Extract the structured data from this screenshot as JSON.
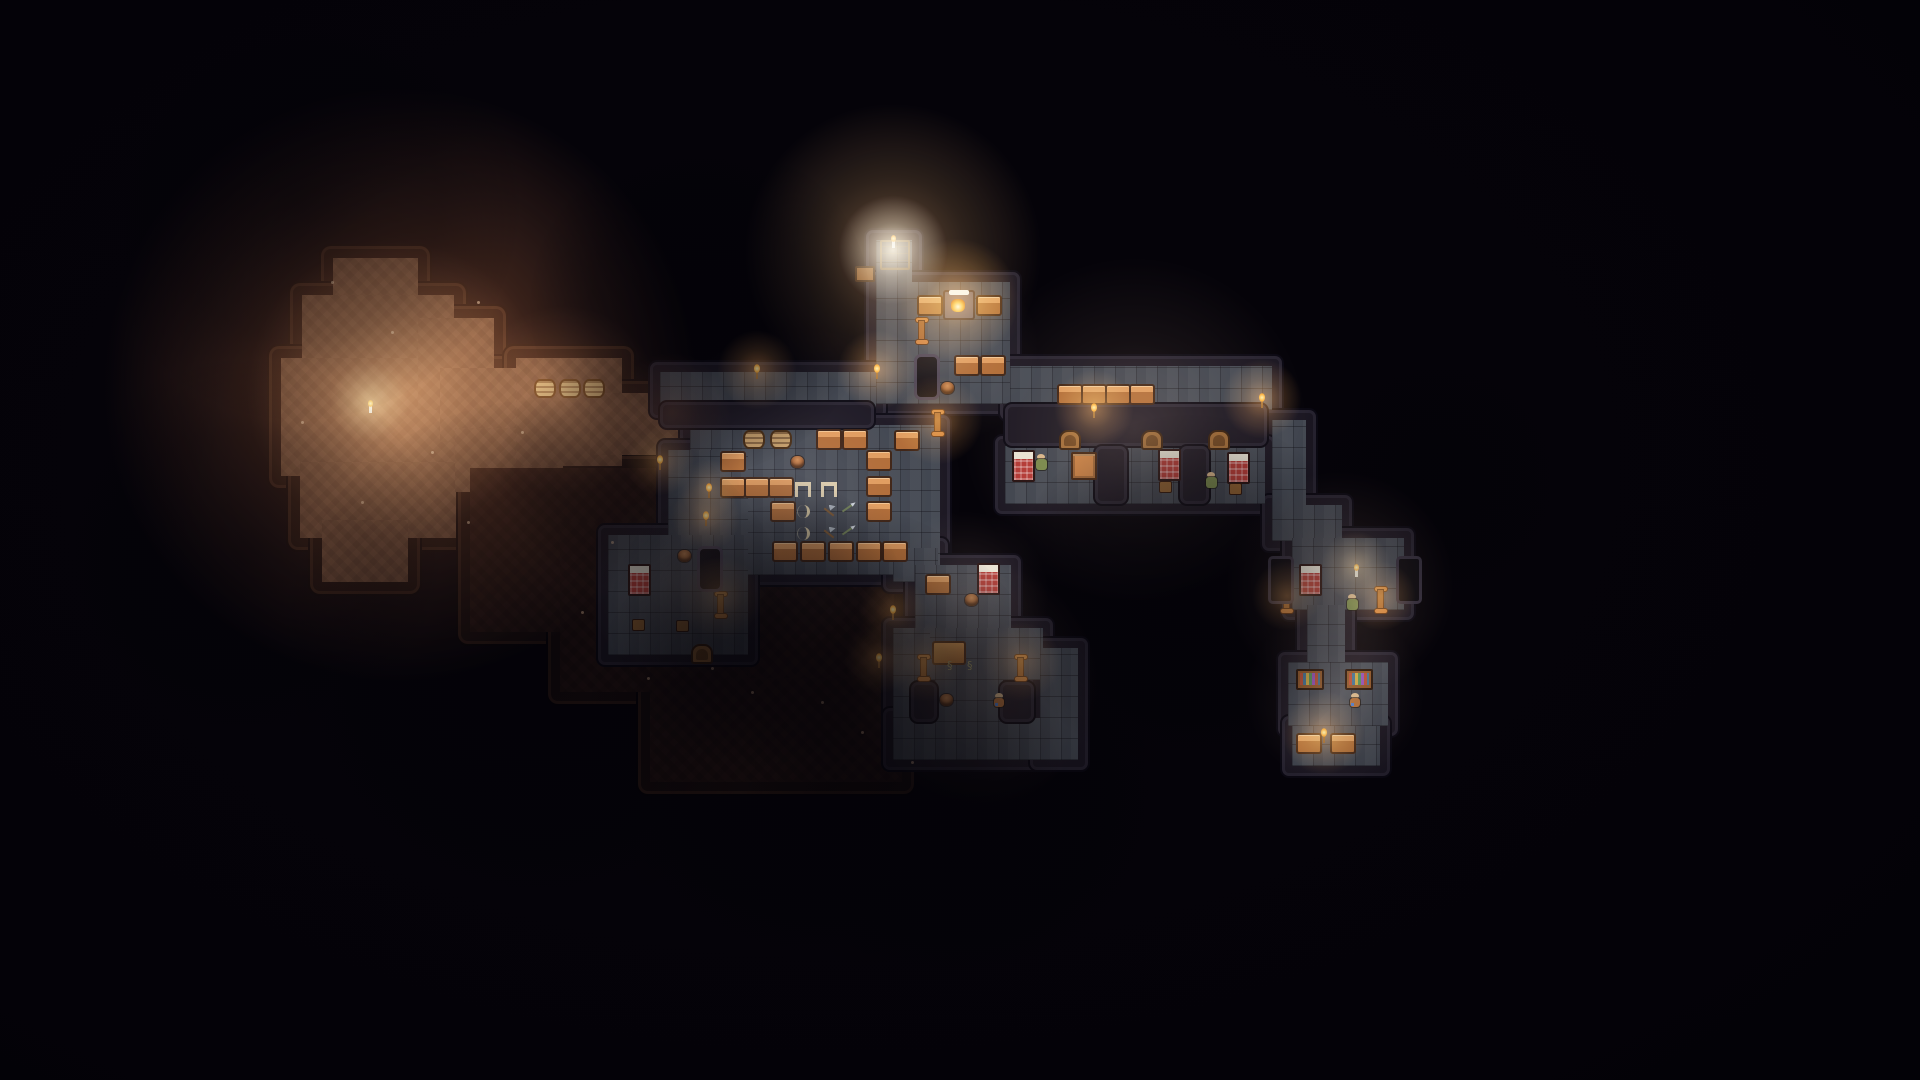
{
  "scene": {
    "width": 1920,
    "height": 1080,
    "background": "#050309",
    "kind": "dungeon-keeper-map"
  },
  "palette": {
    "stone_floor": "#3f444e",
    "stone_wall": "#1b1722",
    "dirt_floor": "#6b4836",
    "dark_dirt": "#241412",
    "chest": "#c07a40",
    "bed": "#b23733",
    "fire": "#ff9020",
    "entrance_light": "#fff2d6"
  },
  "areas": [
    {
      "k": "dirt",
      "x": 333,
      "y": 258,
      "w": 85,
      "h": 55
    },
    {
      "k": "dirt",
      "x": 302,
      "y": 295,
      "w": 152,
      "h": 92
    },
    {
      "k": "dirt",
      "x": 281,
      "y": 358,
      "w": 202,
      "h": 118
    },
    {
      "k": "dirt",
      "x": 300,
      "y": 462,
      "w": 156,
      "h": 76
    },
    {
      "k": "dirt",
      "x": 322,
      "y": 520,
      "w": 86,
      "h": 62
    },
    {
      "k": "dirt",
      "x": 418,
      "y": 318,
      "w": 76,
      "h": 92
    },
    {
      "k": "dirt",
      "x": 440,
      "y": 368,
      "w": 118,
      "h": 74
    },
    {
      "k": "dirt",
      "x": 455,
      "y": 428,
      "w": 108,
      "h": 64
    },
    {
      "k": "dirt",
      "x": 516,
      "y": 358,
      "w": 106,
      "h": 108
    },
    {
      "k": "dirt",
      "x": 590,
      "y": 393,
      "w": 88,
      "h": 62
    },
    {
      "k": "dark",
      "x": 470,
      "y": 468,
      "w": 192,
      "h": 164
    },
    {
      "k": "dark",
      "x": 560,
      "y": 522,
      "w": 232,
      "h": 170
    },
    {
      "k": "dark",
      "x": 650,
      "y": 660,
      "w": 252,
      "h": 122
    },
    {
      "k": "dark",
      "x": 748,
      "y": 560,
      "w": 146,
      "h": 118
    },
    {
      "k": "stone",
      "x": 876,
      "y": 240,
      "w": 36,
      "h": 44
    },
    {
      "k": "stone",
      "x": 876,
      "y": 282,
      "w": 134,
      "h": 122
    },
    {
      "k": "stone",
      "x": 660,
      "y": 372,
      "w": 216,
      "h": 36
    },
    {
      "k": "stone",
      "x": 1010,
      "y": 366,
      "w": 262,
      "h": 44
    },
    {
      "k": "stone",
      "x": 1272,
      "y": 420,
      "w": 34,
      "h": 112
    },
    {
      "k": "stone",
      "x": 1005,
      "y": 446,
      "w": 260,
      "h": 58
    },
    {
      "k": "stone",
      "x": 690,
      "y": 425,
      "w": 250,
      "h": 150
    },
    {
      "k": "stone",
      "x": 668,
      "y": 450,
      "w": 80,
      "h": 112
    },
    {
      "k": "stone",
      "x": 608,
      "y": 535,
      "w": 140,
      "h": 120
    },
    {
      "k": "stone",
      "x": 893,
      "y": 548,
      "w": 45,
      "h": 34
    },
    {
      "k": "stone",
      "x": 915,
      "y": 565,
      "w": 96,
      "h": 72
    },
    {
      "k": "stone",
      "x": 893,
      "y": 628,
      "w": 150,
      "h": 52
    },
    {
      "k": "stone",
      "x": 893,
      "y": 628,
      "w": 37,
      "h": 132
    },
    {
      "k": "stone",
      "x": 893,
      "y": 718,
      "w": 185,
      "h": 42
    },
    {
      "k": "stone",
      "x": 1040,
      "y": 648,
      "w": 38,
      "h": 112
    },
    {
      "k": "stone",
      "x": 935,
      "y": 676,
      "w": 68,
      "h": 46
    },
    {
      "k": "stone",
      "x": 1272,
      "y": 505,
      "w": 70,
      "h": 36
    },
    {
      "k": "stone",
      "x": 1292,
      "y": 538,
      "w": 112,
      "h": 72
    },
    {
      "k": "stone",
      "x": 1307,
      "y": 605,
      "w": 38,
      "h": 62
    },
    {
      "k": "stone",
      "x": 1288,
      "y": 662,
      "w": 100,
      "h": 64
    },
    {
      "k": "stone",
      "x": 1292,
      "y": 726,
      "w": 88,
      "h": 40
    }
  ],
  "inner_walls": [
    {
      "x": 1005,
      "y": 404,
      "w": 262,
      "h": 42
    },
    {
      "x": 1095,
      "y": 446,
      "w": 32,
      "h": 58
    },
    {
      "x": 1180,
      "y": 446,
      "w": 29,
      "h": 58
    },
    {
      "x": 660,
      "y": 402,
      "w": 214,
      "h": 26
    },
    {
      "x": 911,
      "y": 682,
      "w": 26,
      "h": 40
    },
    {
      "x": 1000,
      "y": 682,
      "w": 34,
      "h": 40
    }
  ],
  "entities": [
    {
      "t": "stairs",
      "x": 893,
      "y": 253
    },
    {
      "t": "candle",
      "x": 893,
      "y": 241
    },
    {
      "t": "shelf",
      "x": 863,
      "y": 272
    },
    {
      "t": "furnace",
      "x": 957,
      "y": 303
    },
    {
      "t": "chest",
      "x": 928,
      "y": 303
    },
    {
      "t": "chest",
      "x": 987,
      "y": 303
    },
    {
      "t": "chest",
      "x": 965,
      "y": 363
    },
    {
      "t": "chest",
      "x": 991,
      "y": 363
    },
    {
      "t": "chest",
      "x": 905,
      "y": 438
    },
    {
      "t": "chest",
      "x": 827,
      "y": 437
    },
    {
      "t": "chest",
      "x": 853,
      "y": 437
    },
    {
      "t": "chest",
      "x": 731,
      "y": 459
    },
    {
      "t": "chest",
      "x": 731,
      "y": 485
    },
    {
      "t": "chest",
      "x": 755,
      "y": 485
    },
    {
      "t": "chest",
      "x": 779,
      "y": 485
    },
    {
      "t": "chest",
      "x": 781,
      "y": 509
    },
    {
      "t": "chest",
      "x": 877,
      "y": 458
    },
    {
      "t": "chest",
      "x": 877,
      "y": 484
    },
    {
      "t": "chest",
      "x": 877,
      "y": 509
    },
    {
      "t": "chest",
      "x": 783,
      "y": 549
    },
    {
      "t": "chest",
      "x": 811,
      "y": 549
    },
    {
      "t": "chest",
      "x": 839,
      "y": 549
    },
    {
      "t": "chest",
      "x": 867,
      "y": 549
    },
    {
      "t": "chest",
      "x": 893,
      "y": 549
    },
    {
      "t": "chest",
      "x": 1068,
      "y": 392
    },
    {
      "t": "chest",
      "x": 1092,
      "y": 392
    },
    {
      "t": "chest",
      "x": 1116,
      "y": 392
    },
    {
      "t": "chest",
      "x": 1140,
      "y": 392
    },
    {
      "t": "chest",
      "x": 936,
      "y": 582
    },
    {
      "t": "chest",
      "x": 1307,
      "y": 741
    },
    {
      "t": "chest",
      "x": 1341,
      "y": 741
    },
    {
      "t": "keg",
      "x": 752,
      "y": 437
    },
    {
      "t": "keg",
      "x": 779,
      "y": 437
    },
    {
      "t": "keg",
      "x": 543,
      "y": 386
    },
    {
      "t": "keg",
      "x": 568,
      "y": 386
    },
    {
      "t": "keg",
      "x": 592,
      "y": 386
    },
    {
      "t": "walltorch",
      "x": 757,
      "y": 372
    },
    {
      "t": "walltorch",
      "x": 877,
      "y": 372
    },
    {
      "t": "walltorch",
      "x": 660,
      "y": 463
    },
    {
      "t": "walltorch",
      "x": 706,
      "y": 519
    },
    {
      "t": "walltorch",
      "x": 709,
      "y": 491
    },
    {
      "t": "walltorch",
      "x": 1094,
      "y": 411
    },
    {
      "t": "walltorch",
      "x": 1262,
      "y": 401
    },
    {
      "t": "walltorch",
      "x": 893,
      "y": 613
    },
    {
      "t": "walltorch",
      "x": 879,
      "y": 661
    },
    {
      "t": "walltorch",
      "x": 1324,
      "y": 736
    },
    {
      "t": "candle",
      "x": 370,
      "y": 406
    },
    {
      "t": "candle",
      "x": 1356,
      "y": 570
    },
    {
      "t": "torchstand",
      "x": 922,
      "y": 331
    },
    {
      "t": "torchstand",
      "x": 938,
      "y": 423
    },
    {
      "t": "torchstand",
      "x": 721,
      "y": 605
    },
    {
      "t": "torchstand",
      "x": 924,
      "y": 668
    },
    {
      "t": "torchstand",
      "x": 1021,
      "y": 668
    },
    {
      "t": "torchstand",
      "x": 1287,
      "y": 600
    },
    {
      "t": "torchstand",
      "x": 1381,
      "y": 600
    },
    {
      "t": "coffin",
      "x": 924,
      "y": 374
    },
    {
      "t": "coffin",
      "x": 707,
      "y": 566
    },
    {
      "t": "alcove",
      "x": 1278,
      "y": 577
    },
    {
      "t": "alcove",
      "x": 1406,
      "y": 577
    },
    {
      "t": "bed",
      "x": 637,
      "y": 578
    },
    {
      "t": "bed",
      "x": 986,
      "y": 577
    },
    {
      "t": "bed",
      "x": 1021,
      "y": 464
    },
    {
      "t": "bed",
      "x": 1167,
      "y": 463
    },
    {
      "t": "bed",
      "x": 1236,
      "y": 466
    },
    {
      "t": "bed",
      "x": 1308,
      "y": 578
    },
    {
      "t": "door",
      "x": 1068,
      "y": 438
    },
    {
      "t": "door",
      "x": 1150,
      "y": 438
    },
    {
      "t": "door",
      "x": 1217,
      "y": 438
    },
    {
      "t": "door",
      "x": 700,
      "y": 652
    },
    {
      "t": "crate",
      "x": 1082,
      "y": 464
    },
    {
      "t": "table",
      "x": 947,
      "y": 651
    },
    {
      "t": "bookshelf",
      "x": 1308,
      "y": 677
    },
    {
      "t": "bookshelf",
      "x": 1357,
      "y": 677
    },
    {
      "t": "stool",
      "x": 1164,
      "y": 486
    },
    {
      "t": "stool",
      "x": 1234,
      "y": 488
    },
    {
      "t": "stool",
      "x": 637,
      "y": 624
    },
    {
      "t": "stool",
      "x": 681,
      "y": 625
    },
    {
      "t": "imp",
      "x": 947,
      "y": 388
    },
    {
      "t": "imp",
      "x": 797,
      "y": 462
    },
    {
      "t": "imp",
      "x": 684,
      "y": 556
    },
    {
      "t": "imp",
      "x": 971,
      "y": 600
    },
    {
      "t": "imp",
      "x": 946,
      "y": 700
    },
    {
      "t": "goblin",
      "x": 1041,
      "y": 462
    },
    {
      "t": "goblin",
      "x": 1211,
      "y": 480
    },
    {
      "t": "goblin",
      "x": 1352,
      "y": 602
    },
    {
      "t": "creature",
      "x": 1355,
      "y": 700
    },
    {
      "t": "creature",
      "x": 999,
      "y": 700
    },
    {
      "t": "trousers",
      "x": 800,
      "y": 487
    },
    {
      "t": "trousers",
      "x": 826,
      "y": 487
    },
    {
      "t": "bow",
      "x": 801,
      "y": 511
    },
    {
      "t": "bow",
      "x": 801,
      "y": 533
    },
    {
      "t": "axe",
      "x": 829,
      "y": 510
    },
    {
      "t": "axe",
      "x": 829,
      "y": 532
    },
    {
      "t": "spear",
      "x": 849,
      "y": 507
    },
    {
      "t": "spear",
      "x": 849,
      "y": 530
    },
    {
      "t": "chain",
      "x": 952,
      "y": 666
    },
    {
      "t": "chain",
      "x": 972,
      "y": 666
    },
    {
      "t": "sparkle",
      "x": 332,
      "y": 282
    },
    {
      "t": "sparkle",
      "x": 392,
      "y": 332
    },
    {
      "t": "sparkle",
      "x": 302,
      "y": 422
    },
    {
      "t": "sparkle",
      "x": 432,
      "y": 452
    },
    {
      "t": "sparkle",
      "x": 362,
      "y": 502
    },
    {
      "t": "sparkle",
      "x": 478,
      "y": 302
    },
    {
      "t": "sparkle",
      "x": 522,
      "y": 432
    },
    {
      "t": "sparkle",
      "x": 468,
      "y": 522
    },
    {
      "t": "sparkle",
      "x": 612,
      "y": 542
    },
    {
      "t": "sparkle",
      "x": 648,
      "y": 678
    },
    {
      "t": "sparkle",
      "x": 712,
      "y": 668
    },
    {
      "t": "sparkle",
      "x": 752,
      "y": 692
    },
    {
      "t": "sparkle",
      "x": 822,
      "y": 702
    },
    {
      "t": "sparkle",
      "x": 862,
      "y": 732
    },
    {
      "t": "sparkle",
      "x": 582,
      "y": 612
    },
    {
      "t": "sparkle",
      "x": 912,
      "y": 762
    }
  ],
  "glows": [
    {
      "x": 400,
      "y": 385,
      "r": 300,
      "c": "255,145,85",
      "a": 0.5
    },
    {
      "x": 395,
      "y": 390,
      "r": 150,
      "c": "255,175,105",
      "a": 0.3
    },
    {
      "x": 565,
      "y": 400,
      "r": 95,
      "c": "255,150,90",
      "a": 0.3
    },
    {
      "x": 672,
      "y": 412,
      "r": 60,
      "c": "255,150,90",
      "a": 0.22
    },
    {
      "x": 370,
      "y": 402,
      "r": 40,
      "c": "255,205,130",
      "a": 0.55
    },
    {
      "x": 893,
      "y": 252,
      "r": 150,
      "c": "255,190,120",
      "a": 0.4
    },
    {
      "x": 893,
      "y": 250,
      "r": 55,
      "c": "255,242,214",
      "a": 0.9
    },
    {
      "x": 957,
      "y": 300,
      "r": 62,
      "c": "255,170,70",
      "a": 0.65
    },
    {
      "x": 945,
      "y": 350,
      "r": 95,
      "c": "210,180,160",
      "a": 0.16
    },
    {
      "x": 757,
      "y": 370,
      "r": 40,
      "c": "255,170,80",
      "a": 0.5
    },
    {
      "x": 877,
      "y": 370,
      "r": 40,
      "c": "255,170,80",
      "a": 0.5
    },
    {
      "x": 938,
      "y": 420,
      "r": 45,
      "c": "255,170,80",
      "a": 0.45
    },
    {
      "x": 800,
      "y": 490,
      "r": 165,
      "c": "175,165,175",
      "a": 0.15
    },
    {
      "x": 680,
      "y": 585,
      "r": 95,
      "c": "200,155,120",
      "a": 0.2
    },
    {
      "x": 660,
      "y": 461,
      "r": 35,
      "c": "255,170,80",
      "a": 0.45
    },
    {
      "x": 706,
      "y": 517,
      "r": 35,
      "c": "255,170,80",
      "a": 0.45
    },
    {
      "x": 709,
      "y": 489,
      "r": 30,
      "c": "255,170,80",
      "a": 0.35
    },
    {
      "x": 721,
      "y": 598,
      "r": 42,
      "c": "255,170,80",
      "a": 0.45
    },
    {
      "x": 965,
      "y": 595,
      "r": 85,
      "c": "205,165,135",
      "a": 0.2
    },
    {
      "x": 975,
      "y": 685,
      "r": 125,
      "c": "205,155,115",
      "a": 0.2
    },
    {
      "x": 893,
      "y": 611,
      "r": 35,
      "c": "255,170,80",
      "a": 0.45
    },
    {
      "x": 879,
      "y": 659,
      "r": 35,
      "c": "255,170,80",
      "a": 0.45
    },
    {
      "x": 924,
      "y": 662,
      "r": 40,
      "c": "255,170,80",
      "a": 0.4
    },
    {
      "x": 1021,
      "y": 662,
      "r": 40,
      "c": "255,170,80",
      "a": 0.4
    },
    {
      "x": 1135,
      "y": 430,
      "r": 175,
      "c": "215,175,145",
      "a": 0.2
    },
    {
      "x": 1094,
      "y": 409,
      "r": 40,
      "c": "255,170,80",
      "a": 0.5
    },
    {
      "x": 1262,
      "y": 399,
      "r": 40,
      "c": "255,170,80",
      "a": 0.5
    },
    {
      "x": 1340,
      "y": 585,
      "r": 115,
      "c": "225,175,135",
      "a": 0.22
    },
    {
      "x": 1356,
      "y": 566,
      "r": 35,
      "c": "255,205,130",
      "a": 0.5
    },
    {
      "x": 1287,
      "y": 596,
      "r": 35,
      "c": "255,170,80",
      "a": 0.4
    },
    {
      "x": 1381,
      "y": 596,
      "r": 35,
      "c": "255,170,80",
      "a": 0.4
    },
    {
      "x": 1335,
      "y": 695,
      "r": 90,
      "c": "205,165,135",
      "a": 0.18
    },
    {
      "x": 1324,
      "y": 733,
      "r": 42,
      "c": "255,170,80",
      "a": 0.5
    }
  ],
  "shadows": [
    {
      "x": 540,
      "y": 660,
      "r": 260,
      "a": 0.6
    },
    {
      "x": 820,
      "y": 740,
      "r": 240,
      "a": 0.6
    },
    {
      "x": 700,
      "y": 305,
      "r": 170,
      "a": 0.55
    },
    {
      "x": 1190,
      "y": 595,
      "r": 180,
      "a": 0.5
    },
    {
      "x": 300,
      "y": 200,
      "r": 220,
      "a": 0.5
    },
    {
      "x": 240,
      "y": 560,
      "r": 200,
      "a": 0.45
    },
    {
      "x": 960,
      "y": 790,
      "r": 220,
      "a": 0.5
    },
    {
      "x": 620,
      "y": 470,
      "r": 120,
      "a": 0.35
    },
    {
      "x": 760,
      "y": 620,
      "r": 150,
      "a": 0.45
    },
    {
      "x": 1440,
      "y": 480,
      "r": 150,
      "a": 0.3
    }
  ]
}
